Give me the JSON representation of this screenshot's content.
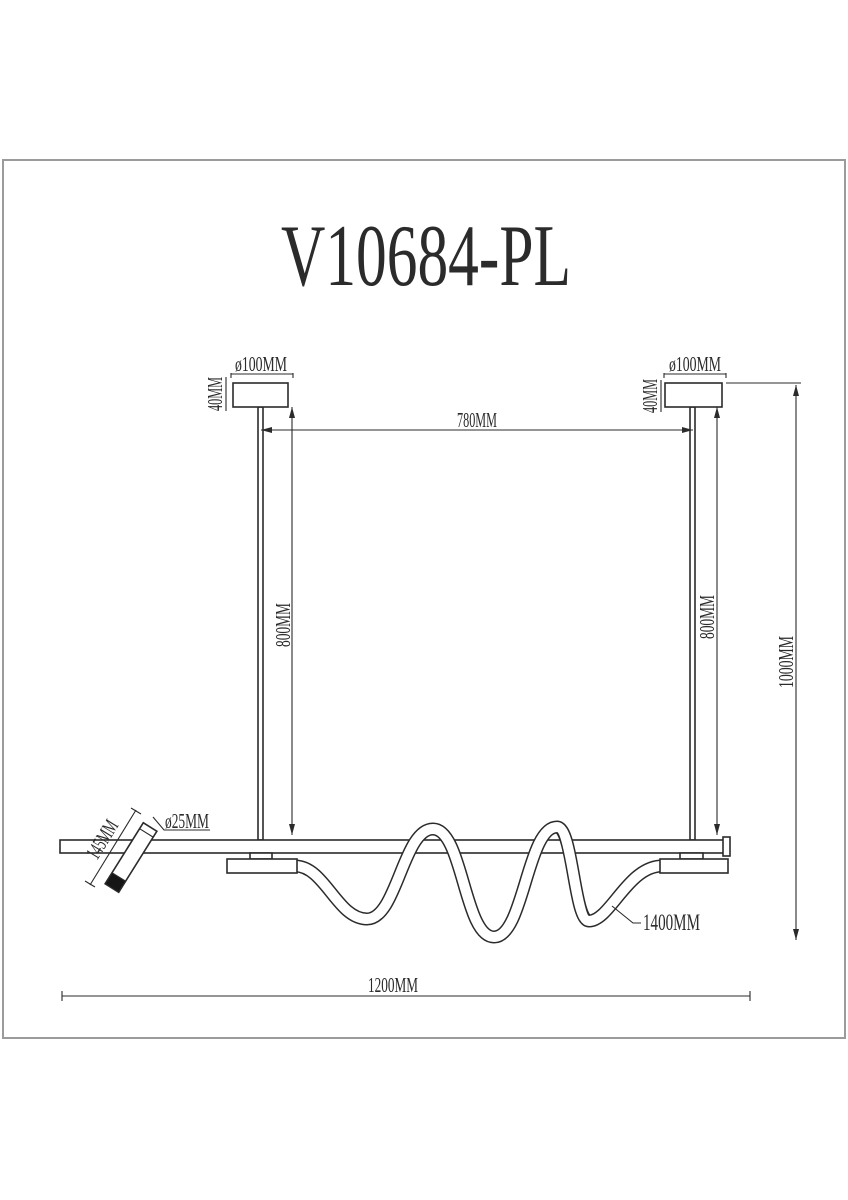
{
  "title": "V10684-PL",
  "colors": {
    "line": "#2b2b2b",
    "border": "#9b9b9b",
    "background": "#ffffff",
    "spot_cap": "#161616"
  },
  "labels": {
    "canopy_left_diameter": "ø100MM",
    "canopy_right_diameter": "ø100MM",
    "canopy_left_thickness": "40MM",
    "canopy_right_thickness": "40MM",
    "rod_spacing": "780MM",
    "left_rod_length": "800MM",
    "right_rod_length": "800MM",
    "overall_height": "1000MM",
    "spot_length": "145MM",
    "spot_diameter": "ø25MM",
    "tube_length": "1400MM",
    "bar_length": "1200MM"
  }
}
